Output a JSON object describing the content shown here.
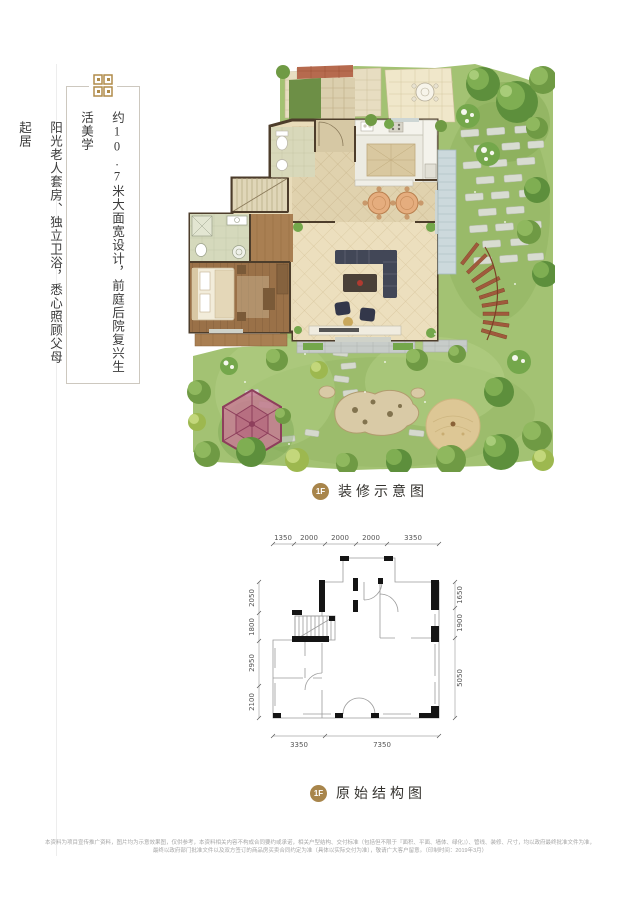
{
  "left_panel": {
    "column1": "约10.7米大面宽设计，前庭后院复兴生活美学",
    "column2": "阳光老人套房、独立卫浴，悉心照顾父母起居"
  },
  "decor_section": {
    "badge": "1F",
    "caption": "装修示意图"
  },
  "structure_section": {
    "badge": "1F",
    "caption": "原始结构图",
    "dims_top": [
      "1350",
      "2000",
      "2000",
      "2000",
      "3350"
    ],
    "dims_left": [
      "2050",
      "1800",
      "2950",
      "2100"
    ],
    "dims_right": [
      "1650",
      "1900",
      "5050"
    ],
    "dims_bottom": [
      "3350",
      "7350"
    ]
  },
  "footer": {
    "line1": "本资料为项目宣传推广资料，图片均为示意效果图，仅供参考，本资料相关内容不构成合同要约或承诺，相关户型结构、交付标准（包括但不限于『面积、平面、墙体、绿化』）、管线、装修、尺寸，均以政府最终批准文件为准，",
    "line2": "最终以政府部门批准文件以及双方签订的商品房买卖合同约定为准（具体以实际交付为准），敬请广大客户留意。（印制时间：2019年3月）"
  },
  "colors": {
    "gold": "#a8854b",
    "text_dark": "#3b3b3b",
    "garden_green": "#a3c273",
    "wall_brown": "#4d3d2b"
  }
}
